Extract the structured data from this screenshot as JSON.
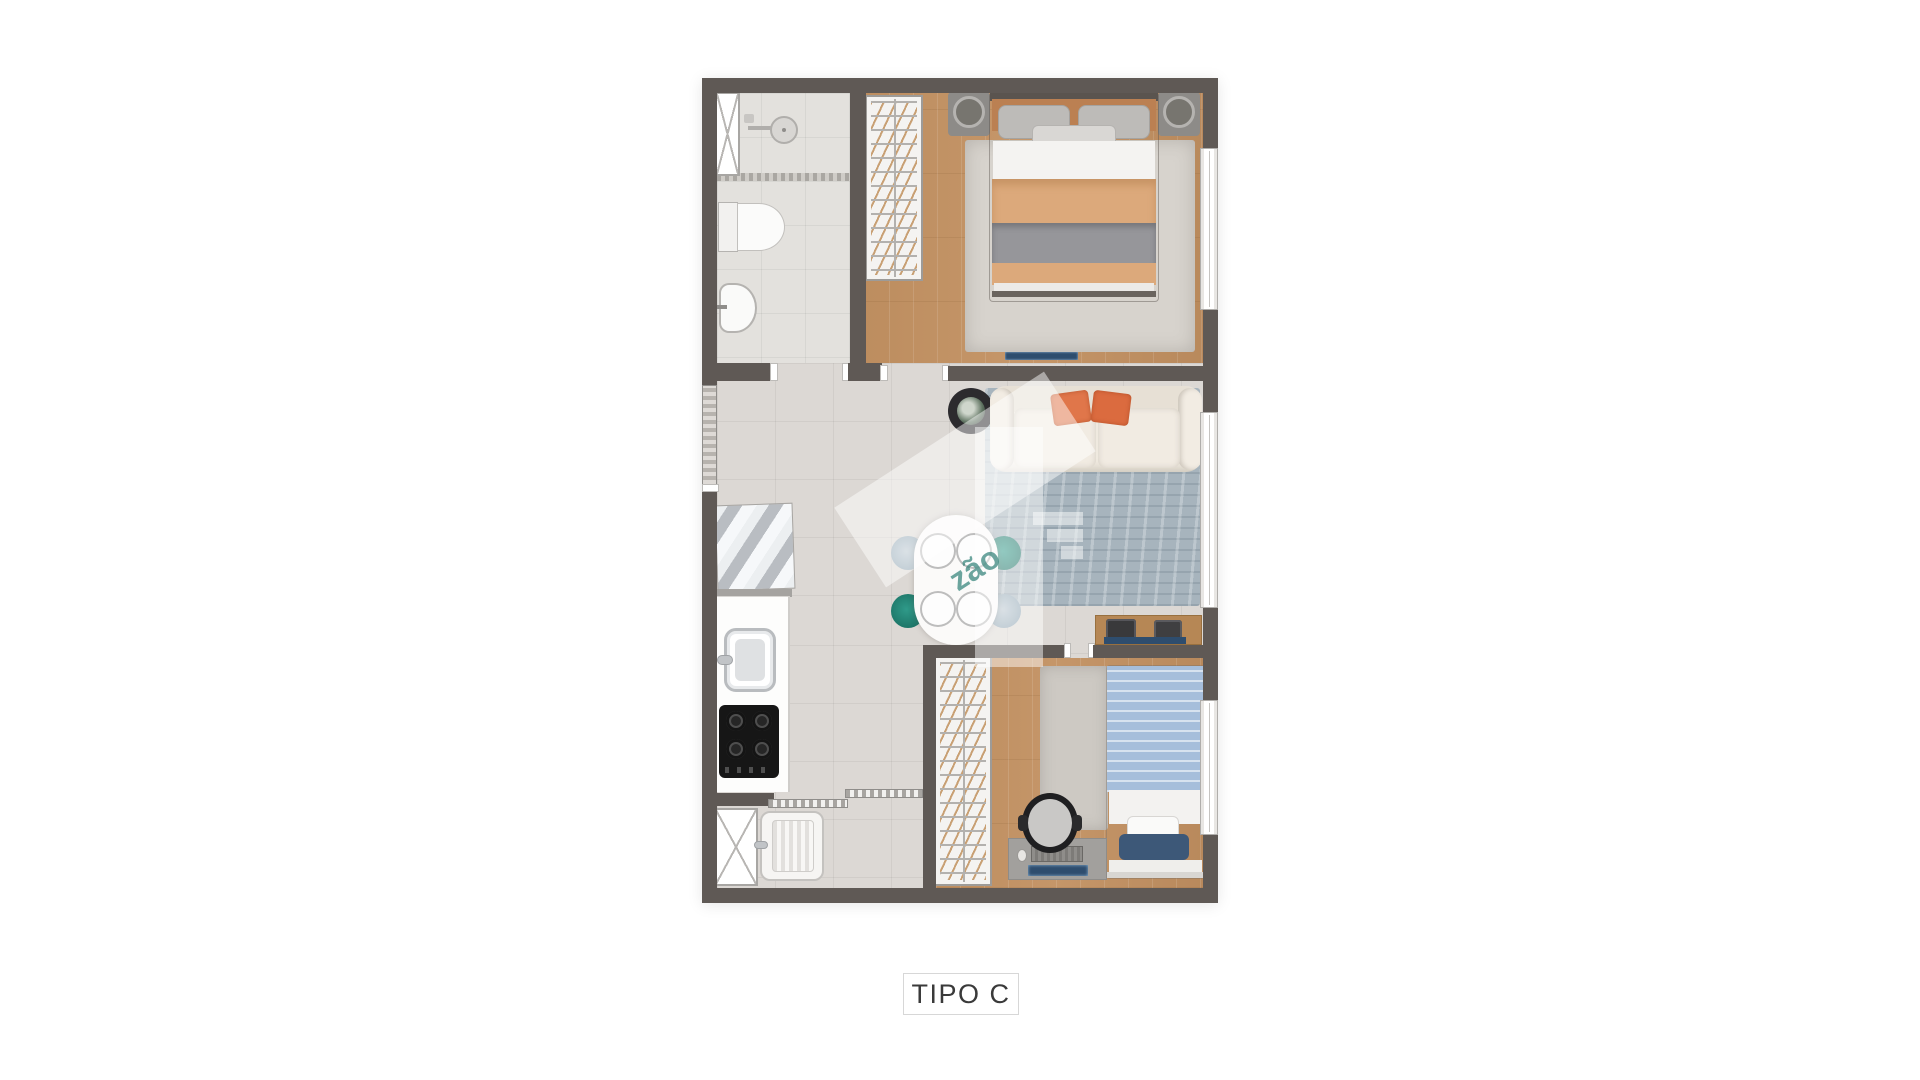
{
  "title": {
    "label": "TIPO C"
  },
  "watermark": {
    "text": "zão"
  },
  "plan": {
    "colors": {
      "wall": "#5f5955",
      "tile": "#dcd8d4",
      "bath_tile": "#e3e1dd",
      "wood": "#c59669",
      "rug_bedroom": "#d7d3cd",
      "rug_living": "#a7b4bd",
      "rug_kids": "#cdc9c3",
      "sofa": "#efe9df",
      "pillow_orange": "#e0764a",
      "teal_chair": "#1d7668",
      "blue_chair": "#8fa5b3",
      "bed_tan": "#dca97b",
      "bed_throw": "#96969a",
      "kids_blue": "#a6bedb",
      "navy": "#2e4d6e",
      "counter": "#fdfdfc",
      "cooktop": "#161616",
      "label_text": "#3a3a3a",
      "wm_teal": "#2f8077"
    },
    "rooms": [
      {
        "name": "bathroom",
        "items": [
          "shower",
          "toilet",
          "washbasin"
        ]
      },
      {
        "name": "master-bedroom",
        "items": [
          "wardrobe",
          "double-bed",
          "nightstand",
          "nightstand",
          "rug",
          "tv-soundbar"
        ]
      },
      {
        "name": "living-dining",
        "items": [
          "sofa",
          "rug",
          "plant-side-table",
          "media-sideboard",
          "dining-table",
          "dining-chairs"
        ]
      },
      {
        "name": "kitchen",
        "items": [
          "refrigerator",
          "counter",
          "sink",
          "cooktop"
        ]
      },
      {
        "name": "service-area",
        "items": [
          "glass-panel",
          "laundry-tub"
        ]
      },
      {
        "name": "kids-bedroom",
        "items": [
          "wardrobe",
          "single-bed",
          "rug",
          "desk",
          "desk-chair"
        ]
      }
    ],
    "windows": 3
  }
}
